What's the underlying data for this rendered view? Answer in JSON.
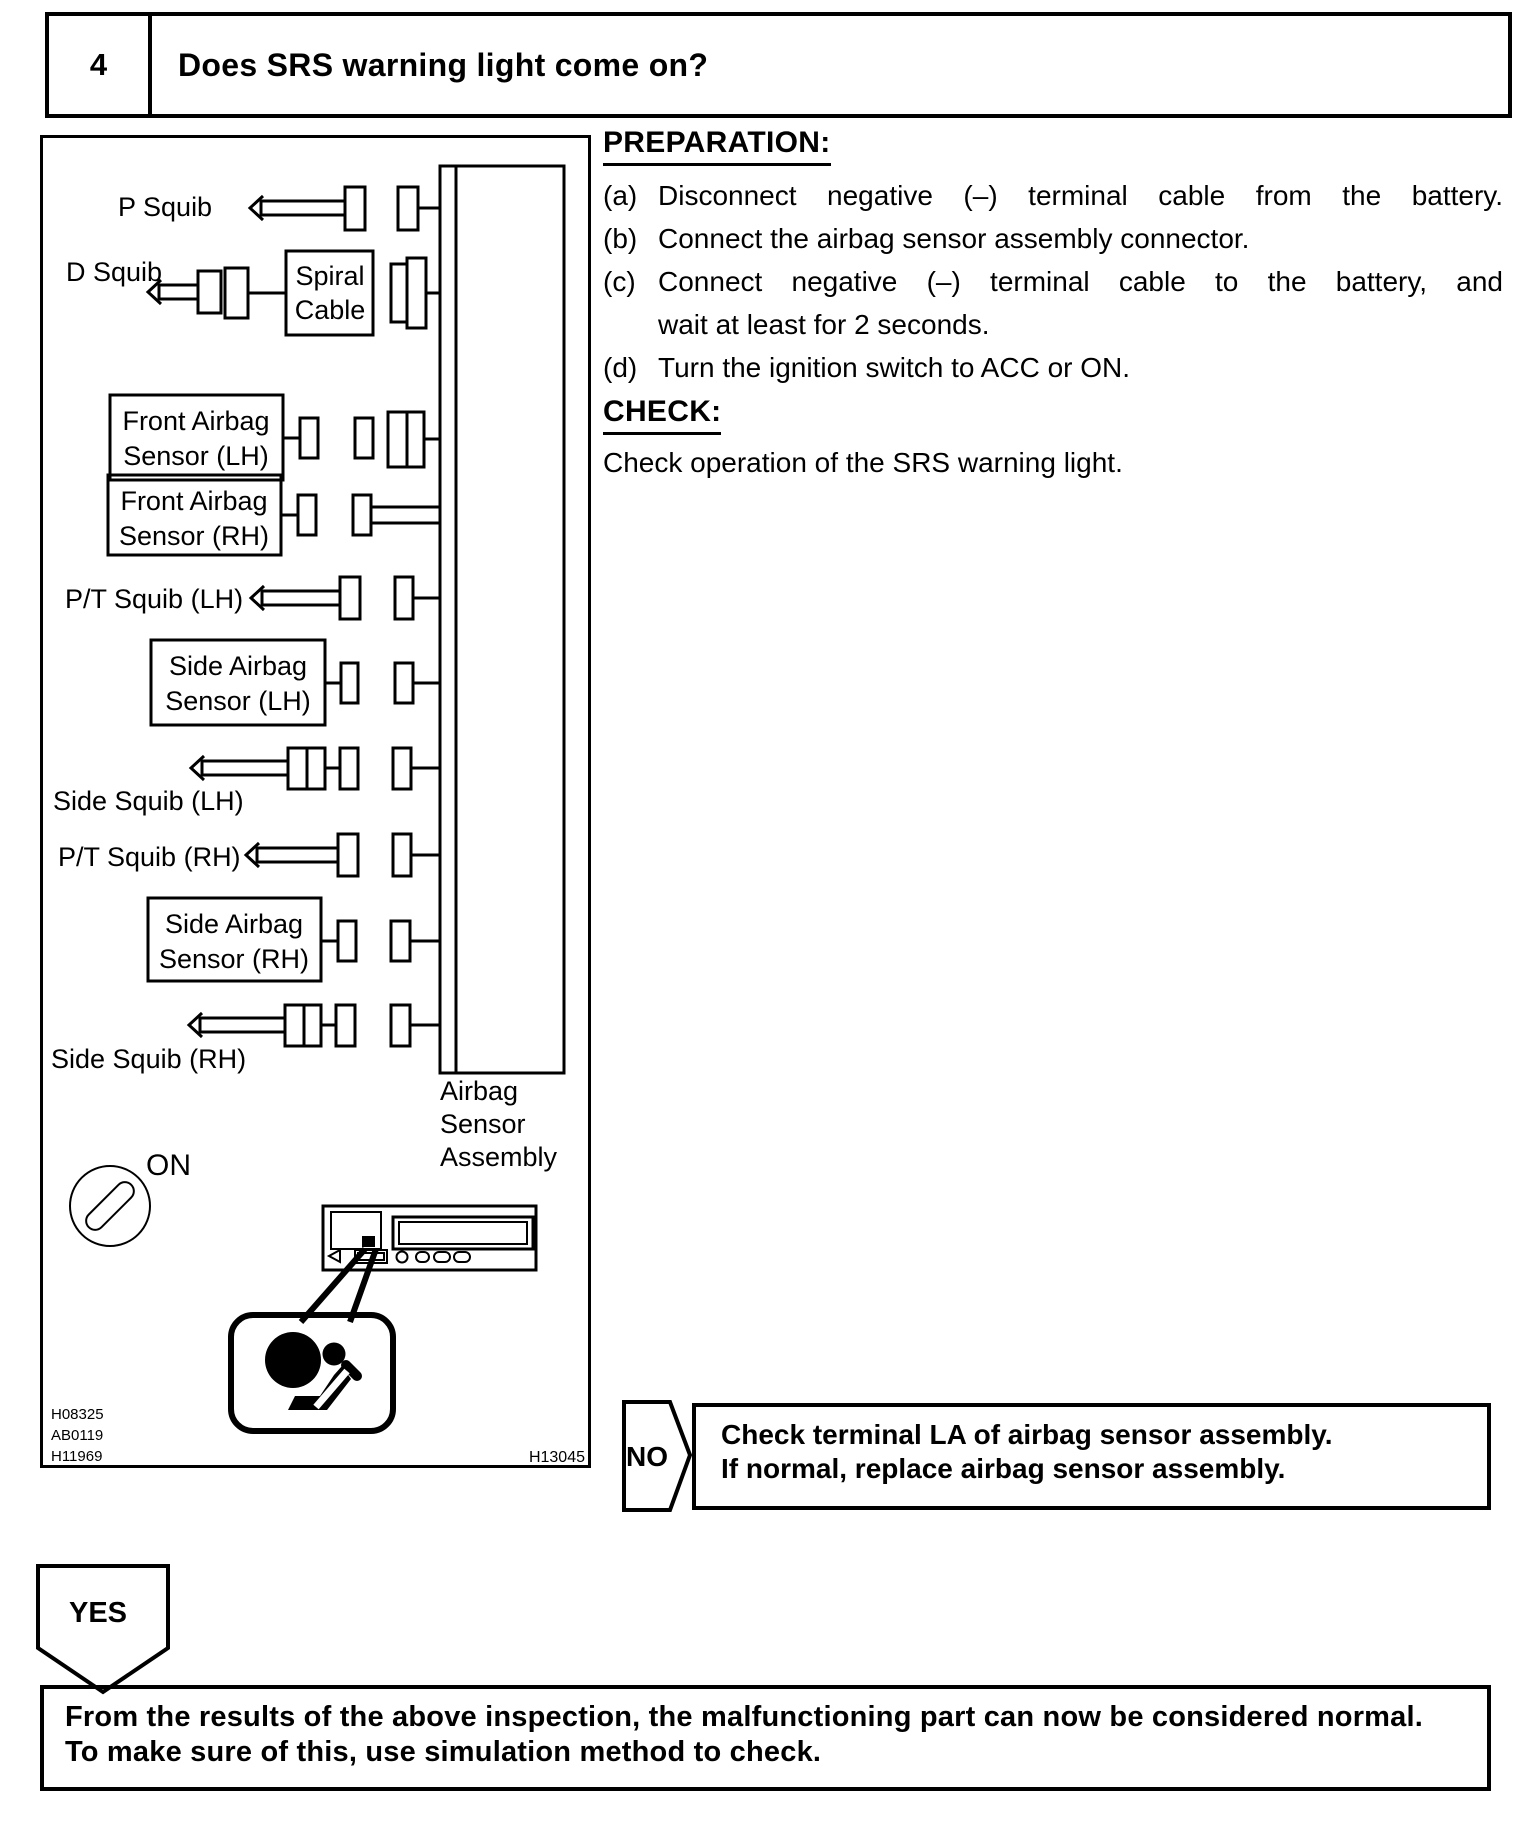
{
  "header": {
    "step_number": "4",
    "question": "Does SRS warning light come on?"
  },
  "procedure": {
    "preparation_title": "PREPARATION:",
    "steps": [
      {
        "label": "(a)",
        "lines": [
          "Disconnect negative (–) terminal cable from the battery."
        ]
      },
      {
        "label": "(b)",
        "lines": [
          "Connect the airbag sensor assembly connector."
        ]
      },
      {
        "label": "(c)",
        "lines": [
          "Connect negative (–) terminal cable to the battery, and",
          "wait at least for 2 seconds."
        ]
      },
      {
        "label": "(d)",
        "lines": [
          "Turn the ignition switch to ACC or ON."
        ]
      }
    ],
    "check_title": "CHECK:",
    "check_text": "Check operation of the SRS warning light."
  },
  "diagram": {
    "labels": {
      "p_squib": "P Squib",
      "d_squib": "D Squib",
      "spiral_cable": [
        "Spiral",
        "Cable"
      ],
      "front_airbag_sensor_lh": [
        "Front Airbag",
        "Sensor (LH)"
      ],
      "front_airbag_sensor_rh": [
        "Front Airbag",
        "Sensor (RH)"
      ],
      "pt_squib_lh": "P/T Squib (LH)",
      "side_airbag_sensor_lh": [
        "Side Airbag",
        "Sensor (LH)"
      ],
      "side_squib_lh": "Side Squib (LH)",
      "pt_squib_rh": "P/T Squib (RH)",
      "side_airbag_sensor_rh": [
        "Side Airbag",
        "Sensor (RH)"
      ],
      "side_squib_rh": "Side Squib (RH)",
      "airbag_sensor_assembly": [
        "Airbag",
        "Sensor",
        "Assembly"
      ],
      "ignition_position": "ON"
    },
    "reference_codes": [
      "H08325",
      "AB0119",
      "H11969"
    ],
    "figure_code": "H13045"
  },
  "decision": {
    "no_label": "NO",
    "no_action_lines": [
      "Check terminal LA of airbag sensor assembly.",
      "If normal, replace airbag sensor assembly."
    ],
    "yes_label": "YES"
  },
  "conclusion": {
    "lines": [
      "From the results of the above inspection, the malfunctioning part can now be considered normal.",
      "To make sure of this, use simulation method to check."
    ]
  }
}
